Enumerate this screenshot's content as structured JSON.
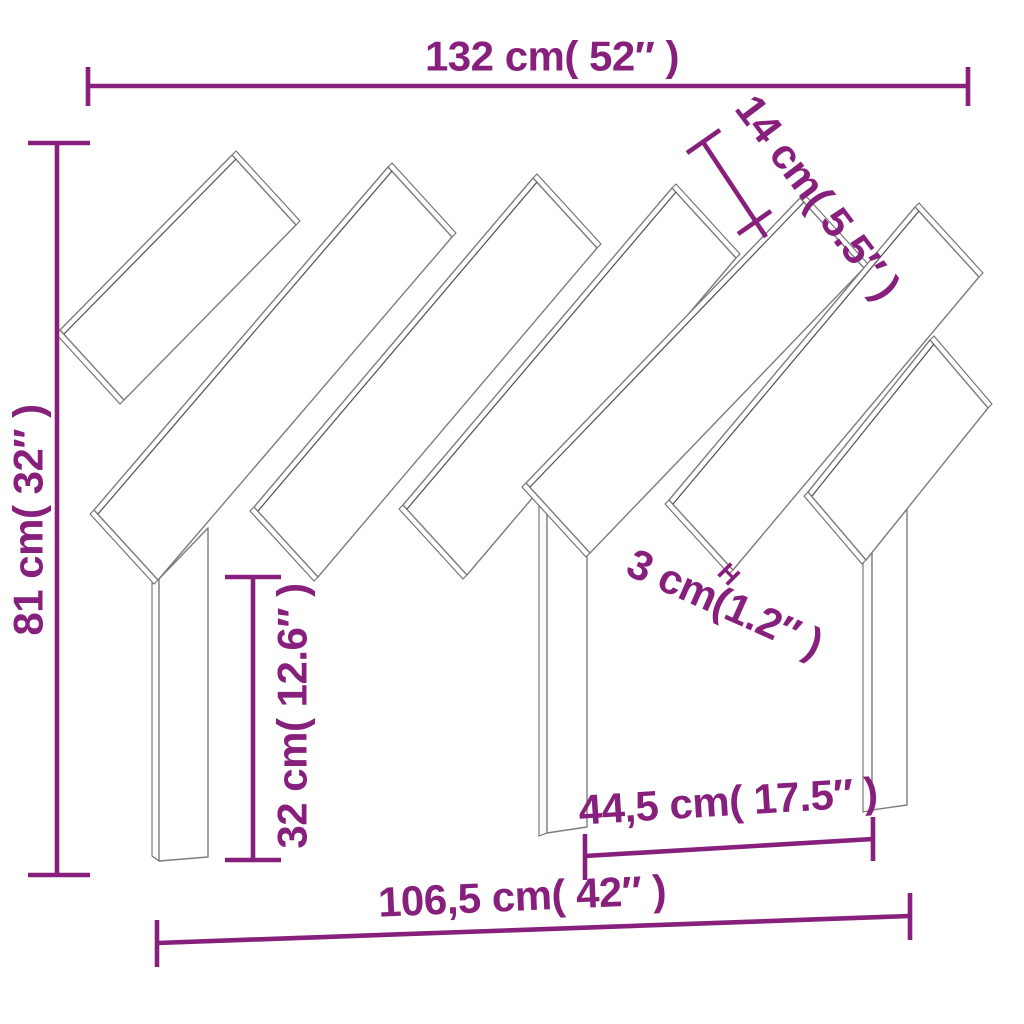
{
  "diagram": {
    "subject": "Bed headboard with diagonal slats - technical dimension drawing",
    "background": "#ffffff",
    "accent_color": "#871F7C",
    "outline_color": "#7d7d7d",
    "outline_dark_color": "#4f4f4f",
    "dimensions": {
      "overall_width": {
        "label": "132 cm( 52″ )"
      },
      "slat_width": {
        "label": "14 cm( 5.5″ )"
      },
      "overall_height": {
        "label": "81 cm( 32″ )"
      },
      "leg_height": {
        "label": "32 cm( 12.6″ )"
      },
      "slat_gap": {
        "label": "3 cm(1.2″ )"
      },
      "inner_leg_span": {
        "label": "44,5 cm( 17.5″ )"
      },
      "outer_leg_span": {
        "label": "106,5 cm( 42″ )"
      },
      "gap_marker": {
        "label": "H"
      }
    }
  }
}
